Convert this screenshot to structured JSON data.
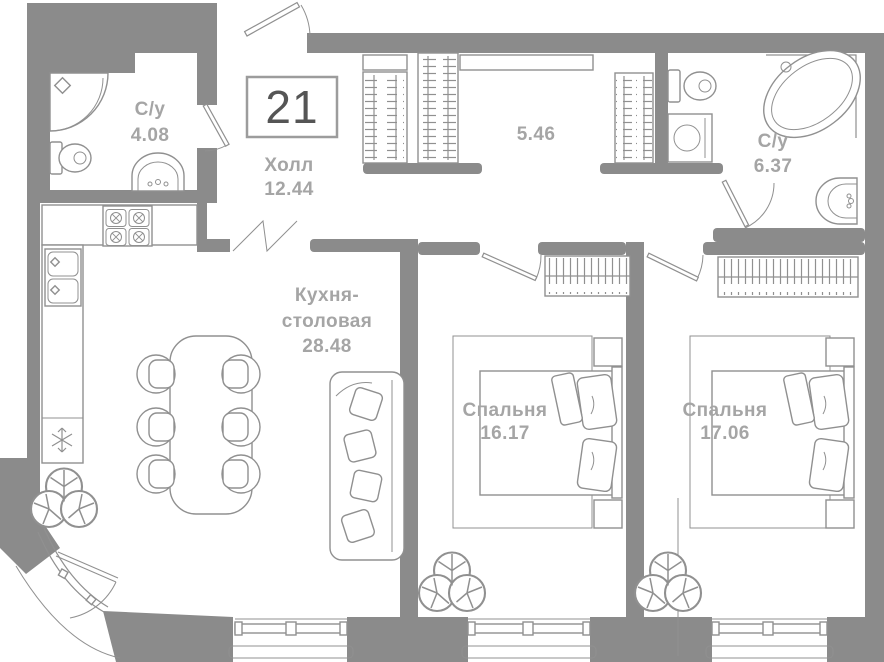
{
  "plan": {
    "unit_number": "21",
    "rooms": {
      "bathroom1": {
        "label": "С/у",
        "area": "4.08"
      },
      "hall": {
        "label": "Холл",
        "area": "12.44"
      },
      "wardrobe_corridor": {
        "area": "5.46"
      },
      "bathroom2": {
        "label": "С/у",
        "area": "6.37"
      },
      "kitchen": {
        "label_line1": "Кухня-",
        "label_line2": "столовая",
        "area": "28.48"
      },
      "bedroom1": {
        "label": "Спальня",
        "area": "16.17"
      },
      "bedroom2": {
        "label": "Спальня",
        "area": "17.06"
      }
    },
    "colors": {
      "wall": "#8b8b8b",
      "furniture": "#909090",
      "text": "#a5a5a5",
      "number": "#555555",
      "border": "#9c9c9c",
      "bg": "#ffffff"
    }
  }
}
